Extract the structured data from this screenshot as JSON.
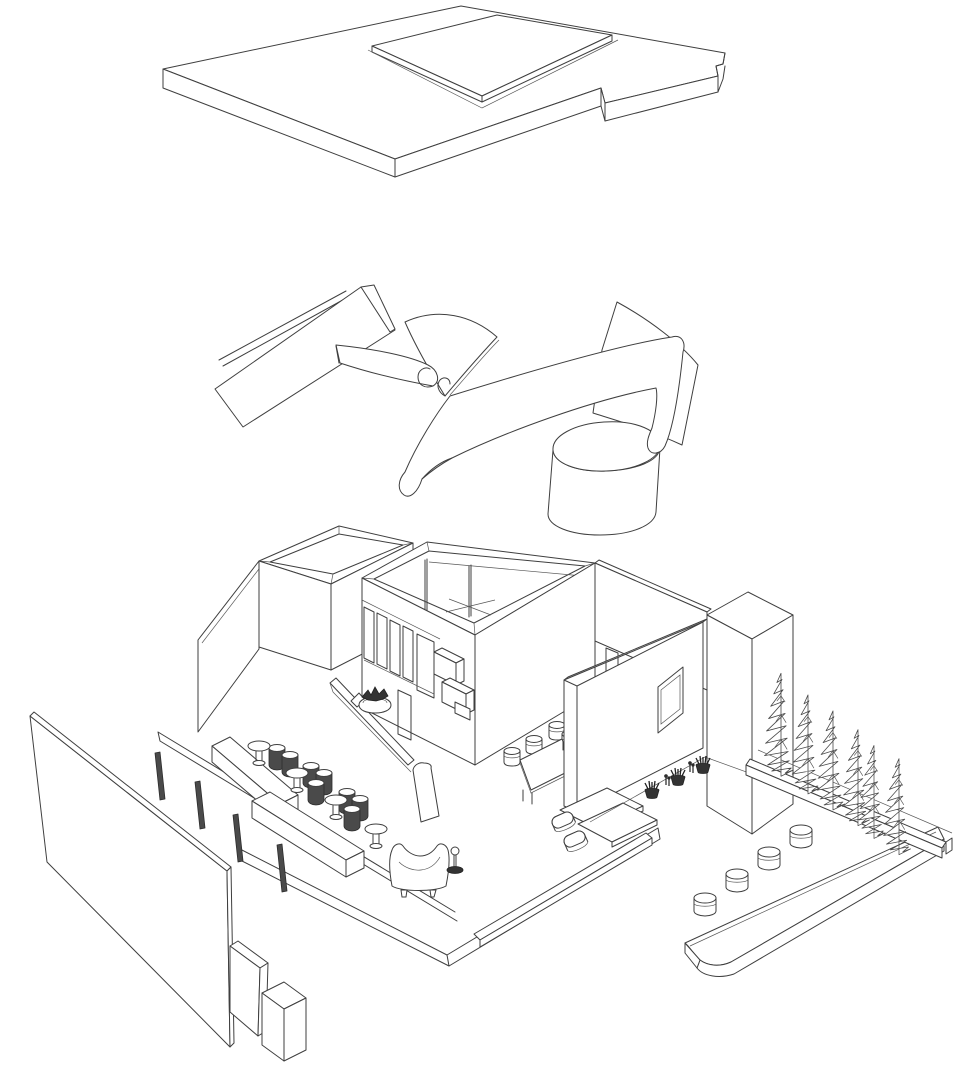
{
  "scene": {
    "title": "Exploded axonometric architectural line drawing",
    "background": "#ffffff",
    "ink": "#3f3f3f",
    "dark_fill": "#4a4a4a",
    "layers": [
      {
        "id": "roof-assembly",
        "label": "Roof slab with raised trapezoidal skylight plate"
      },
      {
        "id": "curved-partitions",
        "label": "Free-form curved sheet partitions and cylindrical volume"
      },
      {
        "id": "site-model",
        "label": "Site model with rooms, glazed pavilion, furniture, planters and cypress trees"
      }
    ],
    "inventory": {
      "cypress_trees": 6,
      "courtyard_stools": 4,
      "dining_stools": 4,
      "mushroom_side_tables": 4,
      "dark_stool_clusters": 3,
      "pavilion_window_panes": 5,
      "glazing_posts": 4,
      "potted_plants": 3,
      "plant_sprigs": 2,
      "benches": 2,
      "armchairs": 1,
      "floor_lamps": 1,
      "end_boxes": 2
    }
  }
}
